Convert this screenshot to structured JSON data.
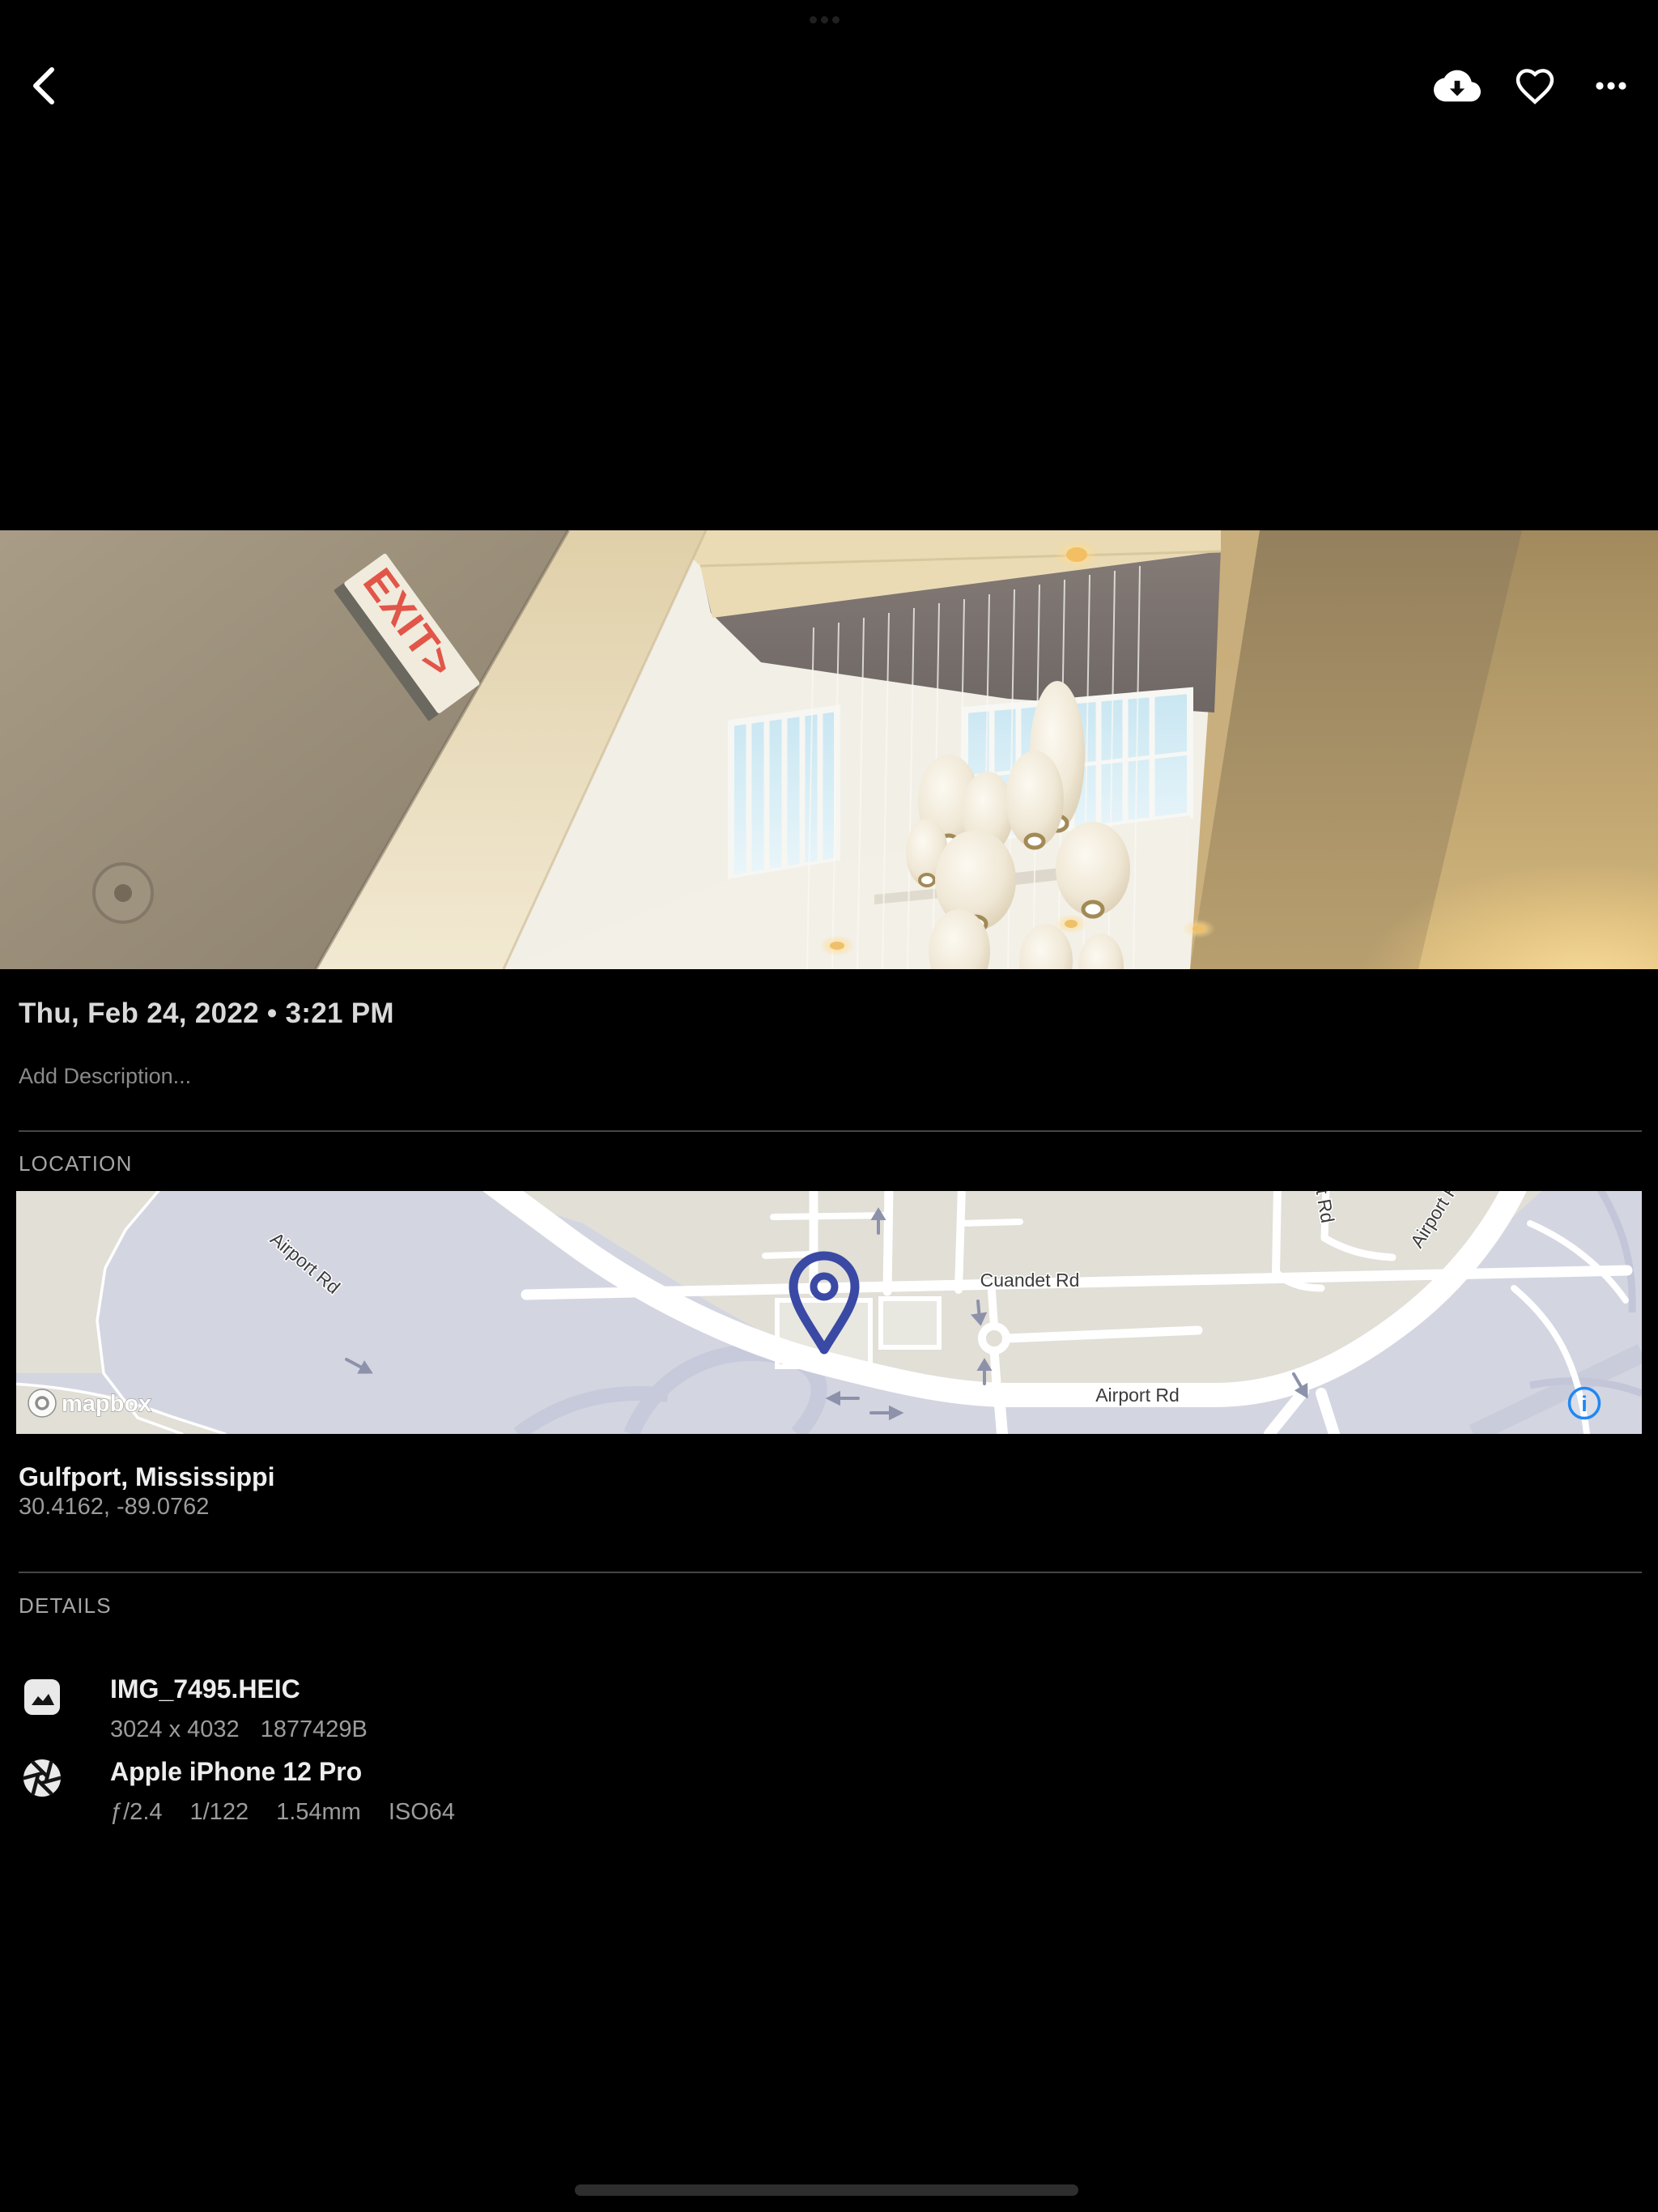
{
  "photo": {
    "exit_sign": "EXIT>"
  },
  "meta": {
    "datetime": "Thu, Feb 24, 2022 • 3:21 PM",
    "description_placeholder": "Add Description..."
  },
  "location": {
    "label": "LOCATION",
    "place": "Gulfport, Mississippi",
    "coordinates": "30.4162, -89.0762",
    "map": {
      "airport_rd": "Airport Rd",
      "cuandet_rd": "Cuandet Rd",
      "attribution": "mapbox",
      "info_label": "i",
      "pin_color": "#3a49a4",
      "info_color": "#1f87f5",
      "land_color": "#d3d5e1",
      "parcel_color": "#e1dfd6"
    }
  },
  "details": {
    "label": "DETAILS",
    "file": {
      "name": "IMG_7495.HEIC",
      "dimensions": "3024 x 4032",
      "size": "1877429B"
    },
    "camera": {
      "name": "Apple iPhone 12 Pro",
      "aperture": "ƒ/2.4",
      "shutter_speed": "1/122",
      "focal_length": "1.54mm",
      "iso": "ISO64"
    }
  }
}
